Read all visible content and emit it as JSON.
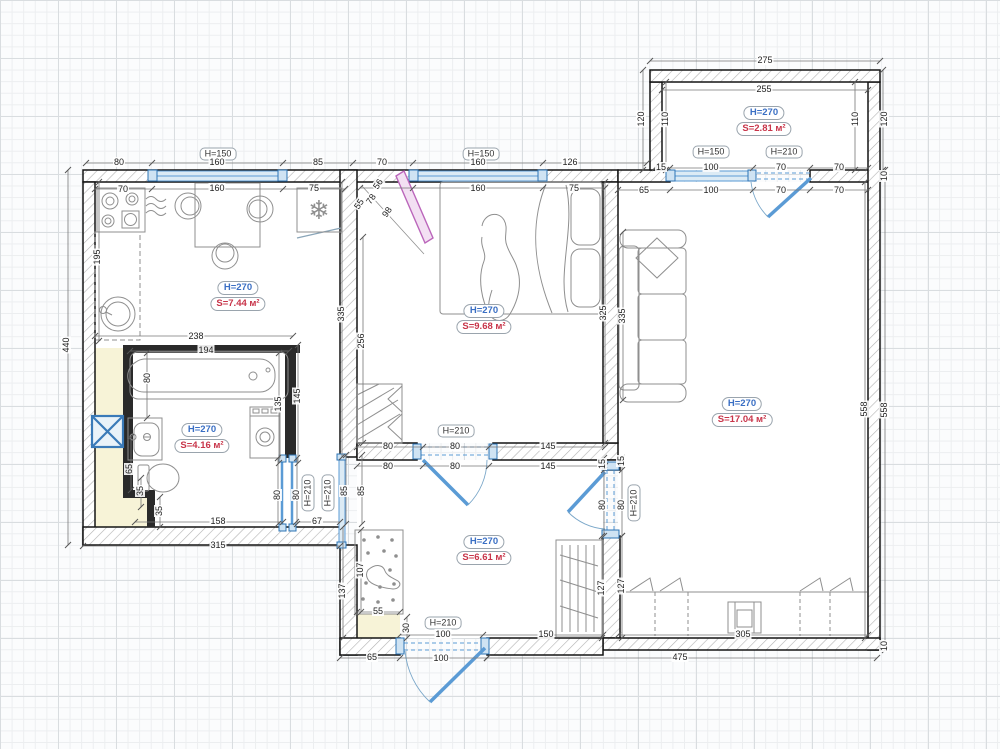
{
  "plan": {
    "rooms": [
      {
        "id": "kitchen",
        "height": "H=270",
        "area": "S=7.44 м²",
        "x": 238,
        "y": 281
      },
      {
        "id": "bathroom",
        "height": "H=270",
        "area": "S=4.16 м²",
        "x": 202,
        "y": 423
      },
      {
        "id": "bedroom",
        "height": "H=270",
        "area": "S=9.68 м²",
        "x": 484,
        "y": 304
      },
      {
        "id": "living-room",
        "height": "H=270",
        "area": "S=17.04 м²",
        "x": 742,
        "y": 397
      },
      {
        "id": "balcony",
        "height": "H=270",
        "area": "S=2.81 м²",
        "x": 764,
        "y": 106
      },
      {
        "id": "hallway",
        "height": "H=270",
        "area": "S=6.61 м²",
        "x": 484,
        "y": 535
      }
    ],
    "opening_labels": [
      {
        "t": "H=150",
        "x": 218,
        "y": 154
      },
      {
        "t": "H=150",
        "x": 481,
        "y": 154
      },
      {
        "t": "H=150",
        "x": 711,
        "y": 152
      },
      {
        "t": "H=210",
        "x": 784,
        "y": 152
      },
      {
        "t": "H=210",
        "x": 456,
        "y": 431
      },
      {
        "t": "H=210",
        "x": 308,
        "y": 493,
        "r": -90
      },
      {
        "t": "H=210",
        "x": 328,
        "y": 493,
        "r": -90
      },
      {
        "t": "H=210",
        "x": 634,
        "y": 503,
        "r": -90
      },
      {
        "t": "H=210",
        "x": 443,
        "y": 623
      }
    ],
    "dimensions": [
      {
        "t": "80",
        "x": 119,
        "y": 162
      },
      {
        "t": "160",
        "x": 217,
        "y": 162
      },
      {
        "t": "85",
        "x": 318,
        "y": 162
      },
      {
        "t": "70",
        "x": 382,
        "y": 162
      },
      {
        "t": "160",
        "x": 478,
        "y": 162
      },
      {
        "t": "126",
        "x": 570,
        "y": 162
      },
      {
        "t": "15",
        "x": 661,
        "y": 167
      },
      {
        "t": "100",
        "x": 711,
        "y": 167
      },
      {
        "t": "70",
        "x": 781,
        "y": 167
      },
      {
        "t": "70",
        "x": 839,
        "y": 167
      },
      {
        "t": "70",
        "x": 123,
        "y": 189
      },
      {
        "t": "160",
        "x": 217,
        "y": 188
      },
      {
        "t": "75",
        "x": 314,
        "y": 188
      },
      {
        "t": "160",
        "x": 478,
        "y": 188
      },
      {
        "t": "75",
        "x": 574,
        "y": 188
      },
      {
        "t": "65",
        "x": 644,
        "y": 190
      },
      {
        "t": "100",
        "x": 711,
        "y": 190
      },
      {
        "t": "70",
        "x": 781,
        "y": 190
      },
      {
        "t": "70",
        "x": 839,
        "y": 190
      },
      {
        "t": "275",
        "x": 765,
        "y": 60
      },
      {
        "t": "255",
        "x": 764,
        "y": 89
      },
      {
        "t": "120",
        "x": 641,
        "y": 119,
        "r": -90
      },
      {
        "t": "110",
        "x": 665,
        "y": 119,
        "r": -90
      },
      {
        "t": "110",
        "x": 855,
        "y": 119,
        "r": -90
      },
      {
        "t": "120",
        "x": 884,
        "y": 119,
        "r": -90
      },
      {
        "t": "10",
        "x": 884,
        "y": 176,
        "r": -90
      },
      {
        "t": "195",
        "x": 97,
        "y": 257,
        "r": -90
      },
      {
        "t": "440",
        "x": 66,
        "y": 345,
        "r": -90
      },
      {
        "t": "238",
        "x": 196,
        "y": 336
      },
      {
        "t": "335",
        "x": 341,
        "y": 314,
        "r": -90
      },
      {
        "t": "56",
        "x": 378,
        "y": 184,
        "r": -56
      },
      {
        "t": "78",
        "x": 371,
        "y": 199,
        "r": -56
      },
      {
        "t": "55",
        "x": 359,
        "y": 204,
        "r": -56
      },
      {
        "t": "98",
        "x": 387,
        "y": 212,
        "r": -56
      },
      {
        "t": "256",
        "x": 361,
        "y": 341,
        "r": -90
      },
      {
        "t": "325",
        "x": 603,
        "y": 313,
        "r": -90
      },
      {
        "t": "335",
        "x": 622,
        "y": 316,
        "r": -90
      },
      {
        "t": "194",
        "x": 206,
        "y": 350
      },
      {
        "t": "80",
        "x": 147,
        "y": 378,
        "r": -90
      },
      {
        "t": "135",
        "x": 278,
        "y": 404,
        "r": -90
      },
      {
        "t": "145",
        "x": 297,
        "y": 396,
        "r": -90
      },
      {
        "t": "65",
        "x": 129,
        "y": 469,
        "r": -90
      },
      {
        "t": "35",
        "x": 140,
        "y": 491,
        "r": -90
      },
      {
        "t": "35",
        "x": 159,
        "y": 511,
        "r": -90
      },
      {
        "t": "80",
        "x": 277,
        "y": 495,
        "r": -90
      },
      {
        "t": "80",
        "x": 296,
        "y": 495,
        "r": -90
      },
      {
        "t": "158",
        "x": 218,
        "y": 521
      },
      {
        "t": "67",
        "x": 317,
        "y": 521
      },
      {
        "t": "315",
        "x": 218,
        "y": 545
      },
      {
        "t": "85",
        "x": 344,
        "y": 491,
        "r": -90
      },
      {
        "t": "85",
        "x": 361,
        "y": 491,
        "r": -90
      },
      {
        "t": "80",
        "x": 388,
        "y": 446
      },
      {
        "t": "80",
        "x": 455,
        "y": 446
      },
      {
        "t": "145",
        "x": 548,
        "y": 446
      },
      {
        "t": "80",
        "x": 388,
        "y": 466
      },
      {
        "t": "80",
        "x": 455,
        "y": 466
      },
      {
        "t": "145",
        "x": 548,
        "y": 466
      },
      {
        "t": "15",
        "x": 602,
        "y": 464,
        "r": -90
      },
      {
        "t": "80",
        "x": 602,
        "y": 505,
        "r": -90
      },
      {
        "t": "15",
        "x": 621,
        "y": 461,
        "r": -90
      },
      {
        "t": "80",
        "x": 621,
        "y": 505,
        "r": -90
      },
      {
        "t": "127",
        "x": 621,
        "y": 586,
        "r": -90
      },
      {
        "t": "127",
        "x": 601,
        "y": 588,
        "r": -90
      },
      {
        "t": "107",
        "x": 360,
        "y": 570,
        "r": -90
      },
      {
        "t": "137",
        "x": 342,
        "y": 591,
        "r": -90
      },
      {
        "t": "55",
        "x": 378,
        "y": 611
      },
      {
        "t": "30",
        "x": 406,
        "y": 628,
        "r": -90
      },
      {
        "t": "100",
        "x": 443,
        "y": 634
      },
      {
        "t": "150",
        "x": 546,
        "y": 634
      },
      {
        "t": "65",
        "x": 372,
        "y": 657
      },
      {
        "t": "100",
        "x": 441,
        "y": 658
      },
      {
        "t": "305",
        "x": 743,
        "y": 634
      },
      {
        "t": "475",
        "x": 680,
        "y": 657
      },
      {
        "t": "558",
        "x": 864,
        "y": 409,
        "r": -90
      },
      {
        "t": "558",
        "x": 884,
        "y": 410,
        "r": -90
      },
      {
        "t": "10",
        "x": 884,
        "y": 646,
        "r": -90
      }
    ],
    "icons": {
      "fridge": "❄"
    },
    "colors": {
      "wall_outline": "#141414",
      "opening_blue": "#5b9bd5",
      "opening_fill": "#dcebf5",
      "height_label": "#3a6fc4",
      "area_label": "#c8354a",
      "furniture": "#8f8f8f",
      "accent_pink": "#bb66bb",
      "shaft_fill": "#f7f3d7"
    }
  }
}
